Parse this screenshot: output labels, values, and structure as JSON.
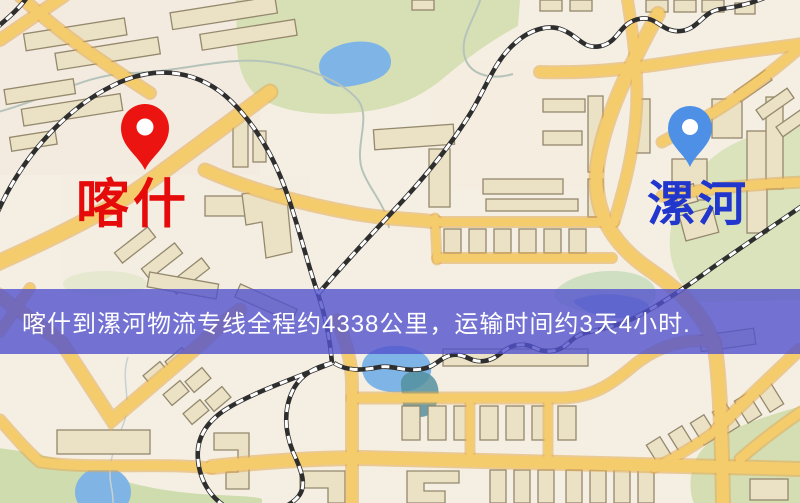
{
  "banner": {
    "text": "喀什到漯河物流专线全程约4338公里，运输时间约3天4小时.",
    "background_color": "#5353cd",
    "text_color": "#ffffff",
    "distance_text": "约4338公里",
    "duration_text": "约3天4小时"
  },
  "markers": {
    "origin": {
      "name": "喀什",
      "pin_color": "#ec1410",
      "label_color": "#e60b0b"
    },
    "destination": {
      "name": "漯河",
      "pin_color": "#4d90e6",
      "label_color": "#2136cd"
    }
  },
  "map_colors": {
    "background": "#f5efe3",
    "road": "#f5cc6b",
    "road_casing": "#e2aa52",
    "park": "#d7e0b4",
    "water": "#7fb5e6",
    "building_fill": "#ebe2c6",
    "building_stroke": "#94886d",
    "railway": "#2e2e2e"
  }
}
